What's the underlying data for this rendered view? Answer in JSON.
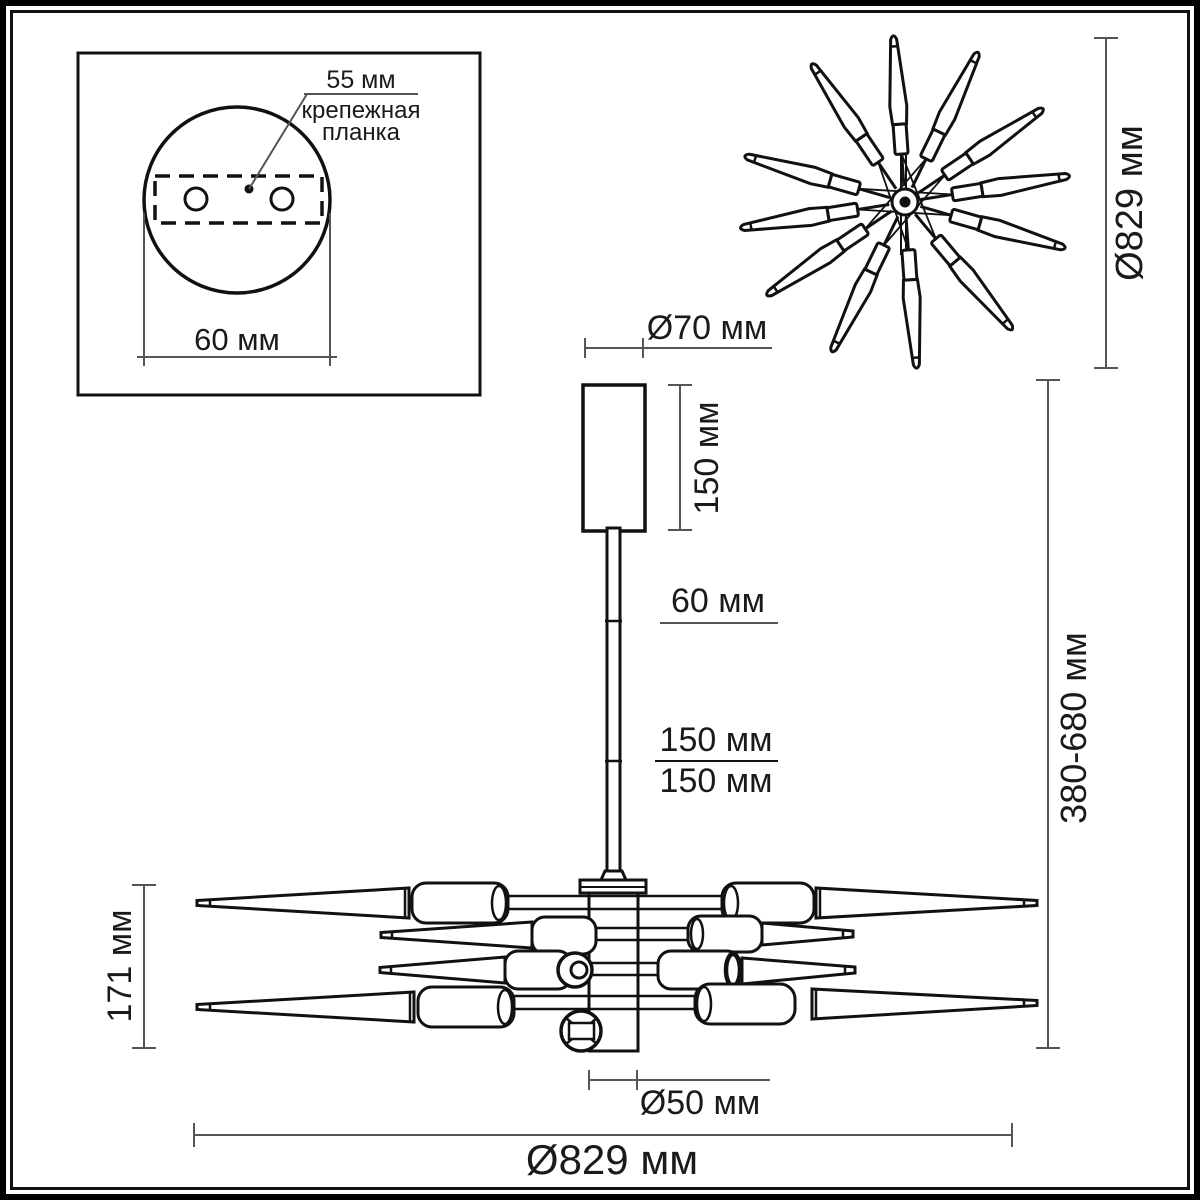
{
  "detail": {
    "offset": "55 мм",
    "plate_line1": "крепежная",
    "plate_line2": "планка",
    "width": "60 мм"
  },
  "top": {
    "diameter": "Ø829 мм"
  },
  "side": {
    "canopy_d": "Ø70 мм",
    "canopy_h": "150 мм",
    "stem": "60 мм",
    "rod1": "150 мм",
    "rod2": "150 мм",
    "height": "380-680 мм",
    "arms_h": "171 мм",
    "hub_d": "Ø50 мм",
    "fixture_d": "Ø829 мм"
  },
  "colors": {
    "line": "#111111",
    "dimension": "#555555",
    "text": "#1a1a1a",
    "background": "#ffffff"
  }
}
